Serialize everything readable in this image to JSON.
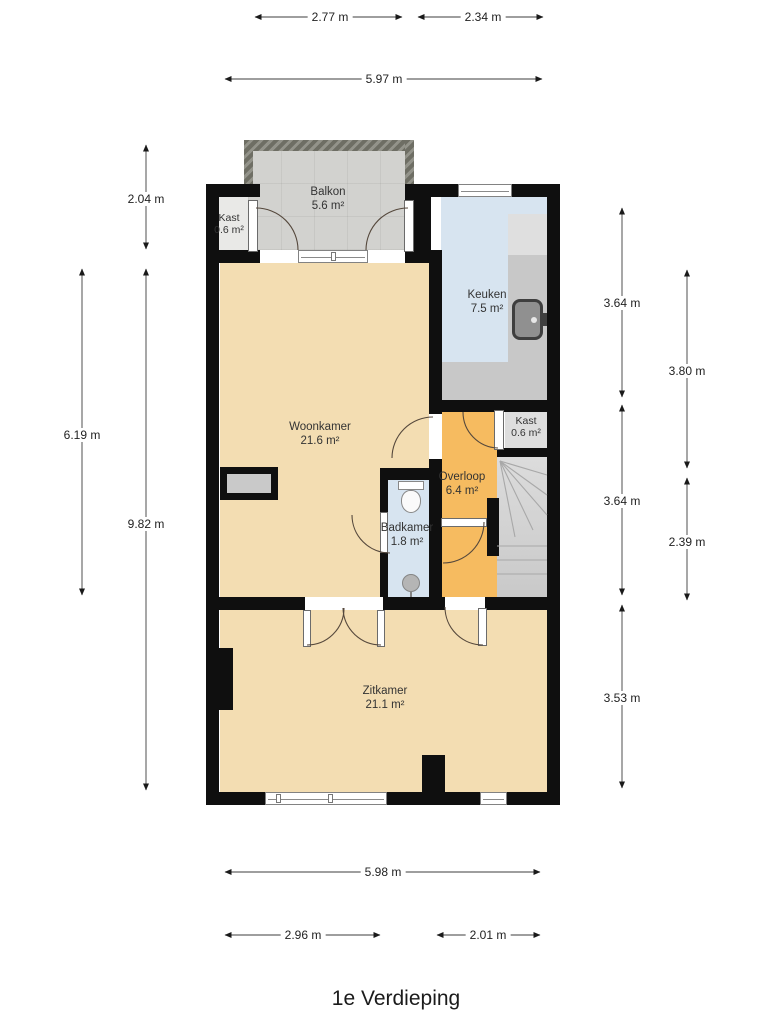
{
  "title": "1e Verdieping",
  "rooms": [
    {
      "id": "balkon",
      "name": "Balkon",
      "area": "5.6 m²",
      "color": "#d2d2cf"
    },
    {
      "id": "kast-balkon",
      "name": "Kast",
      "area": "0.6 m²",
      "color": "#e9e9e7"
    },
    {
      "id": "keuken",
      "name": "Keuken",
      "area": "7.5 m²",
      "color": "#d7e4f0"
    },
    {
      "id": "woonkamer",
      "name": "Woonkamer",
      "area": "21.6 m²",
      "color": "#f3ddb2"
    },
    {
      "id": "kast-overloop",
      "name": "Kast",
      "area": "0.6 m²",
      "color": "#dedede"
    },
    {
      "id": "overloop",
      "name": "Overloop",
      "area": "6.4 m²",
      "color": "#f6bb60"
    },
    {
      "id": "badkamer",
      "name": "Badkamer",
      "area": "1.8 m²",
      "color": "#d7e4f0"
    },
    {
      "id": "zitkamer",
      "name": "Zitkamer",
      "area": "21.1 m²",
      "color": "#f3ddb2"
    }
  ],
  "dimensions": {
    "top": [
      "2.77 m",
      "2.34 m",
      "5.97 m"
    ],
    "left": [
      "2.04 m",
      "6.19 m",
      "9.82 m"
    ],
    "right": [
      "3.64 m",
      "3.80 m",
      "3.64 m",
      "2.39 m",
      "3.53 m"
    ],
    "bottom": [
      "5.98 m",
      "2.96 m",
      "2.01 m"
    ]
  },
  "colors": {
    "wall": "#0f0f0f",
    "counter": "#c8c8c8",
    "counter_light": "#dfdfdf",
    "stairs": "#d4d4d4",
    "railing_hatch": "#6e6e64",
    "dimension_line": "#3c3c3c",
    "door_arc": "#55483c"
  }
}
